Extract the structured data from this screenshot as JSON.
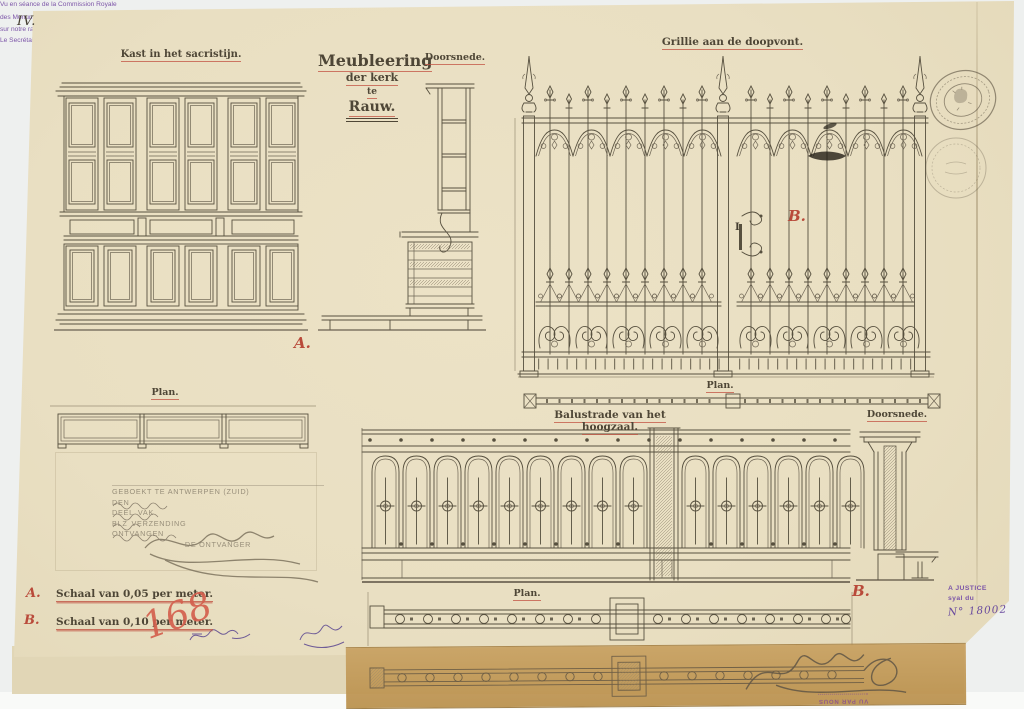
{
  "page": {
    "number": "IV.",
    "colors": {
      "paper": "#eae0c4",
      "ink": "#57503f",
      "red": "#b94a3a",
      "purple": "#7c55a8",
      "tan": "#c49c5e"
    }
  },
  "titles": {
    "main": {
      "line1": "Meubleering",
      "line2": "der kerk",
      "line3": "te",
      "line4": "Rauw."
    },
    "cabinet": "Kast in het sacristijn.",
    "cabinet_section": "Doorsnede.",
    "cabinet_plan": "Plan.",
    "grille": "Grillie aan de doopvont.",
    "grille_plan": "Plan.",
    "balustrade": "Balustrade van het hoogzaal.",
    "balustrade_section": "Doorsnede.",
    "balustrade_plan": "Plan."
  },
  "marks": {
    "letter_a": "A.",
    "letter_b_grille": "B.",
    "letter_b_balustrade": "B.",
    "door_mark": "I",
    "archive_number": "168"
  },
  "legend": {
    "a_letter": "A.",
    "a_text": "Schaal van 0,05 per meter.",
    "b_letter": "B.",
    "b_text": "Schaal van 0,10 per meter."
  },
  "commission_stamp": {
    "line1": "Vu en séance de la Commission Royale",
    "line2_prefix": "des Monuments, le",
    "line2_date": "9 7bre 1893",
    "line3_prefix": "sur notre rapport du",
    "line3_value": "16 de ce mois N° 8000",
    "secretary_label": "Le Secrétaire,",
    "president_label": "Le Président,"
  },
  "registry_stamp": {
    "line1": "GEBOEKT TE ANTWERPEN (ZUID)",
    "den": "DEN",
    "deel": "DEEL",
    "vak": "VAK",
    "blz": "BLZ",
    "verzending": "VERZENDING",
    "ontvangen": "ONTVANGEN",
    "ontvanger": "DE ONTVANGER"
  },
  "justice_stamp": {
    "line1": "A JUSTICE",
    "line2": "syal du",
    "number": "N° 18002"
  },
  "verso_stamp": {
    "line1": "VU PAR NOUS"
  }
}
